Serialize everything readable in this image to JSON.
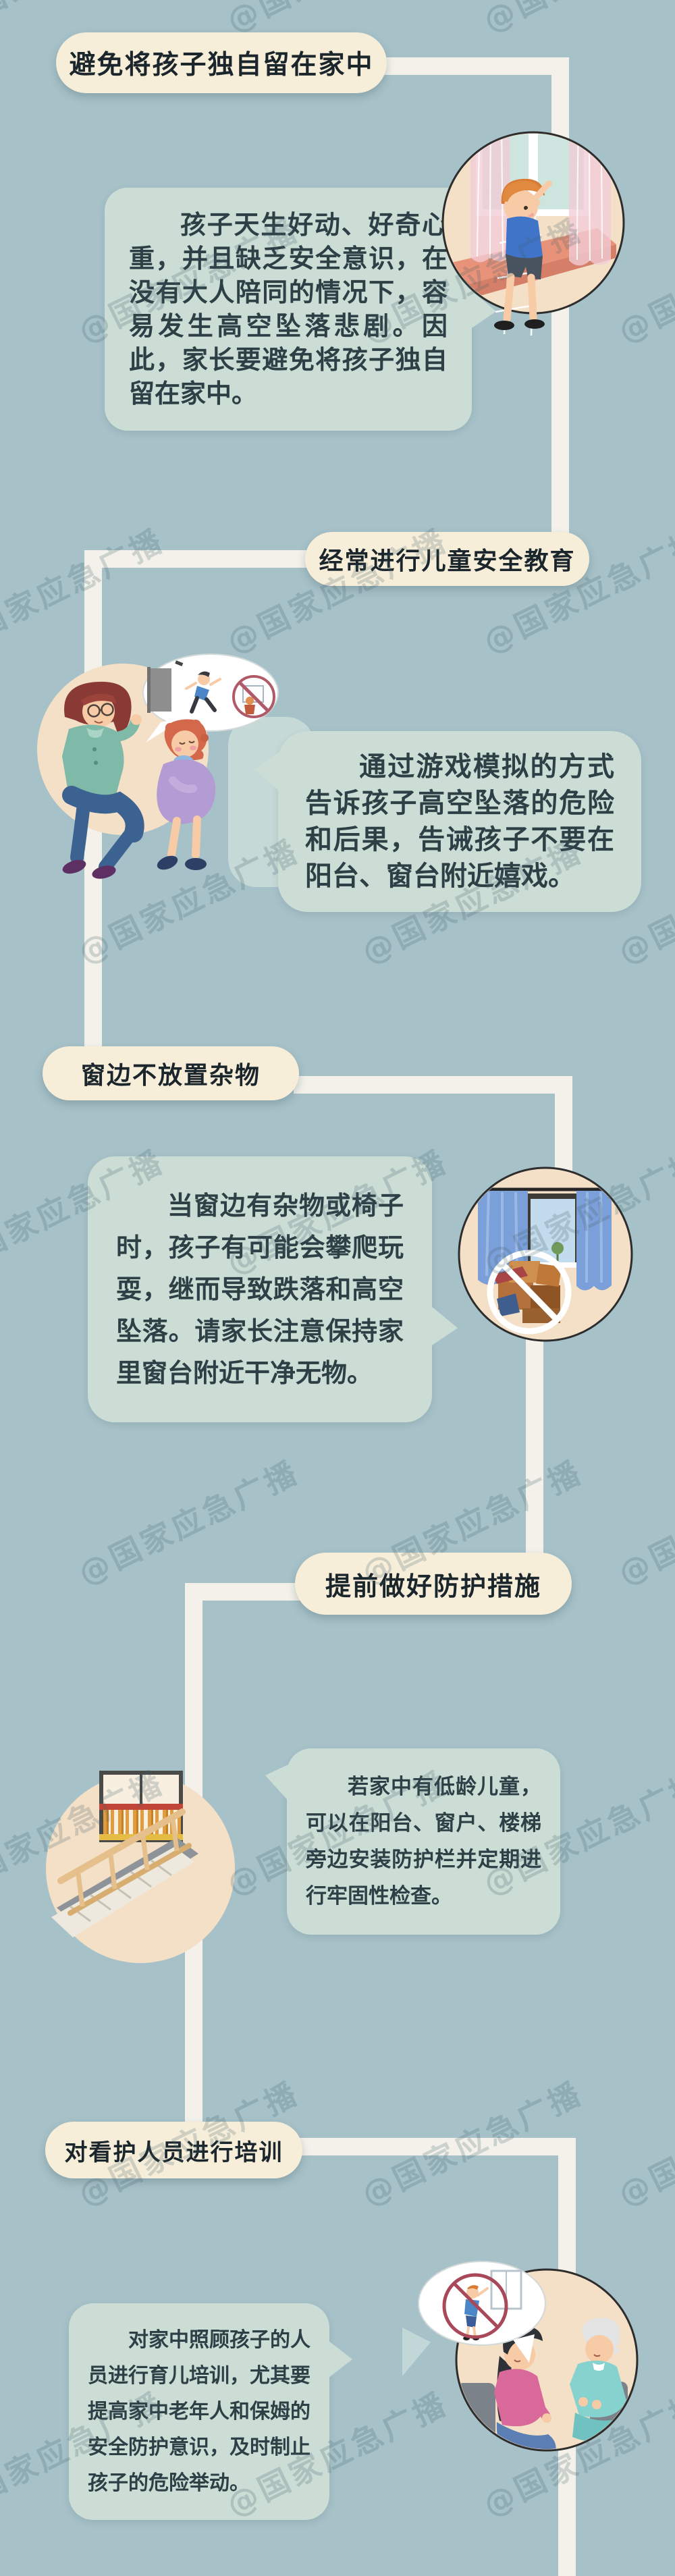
{
  "page": {
    "language": "zh-CN",
    "topic": "儿童高空坠落预防安全知识"
  },
  "watermark": {
    "text": "@国家应急广播"
  },
  "colors": {
    "background": "#a6c1c8",
    "title_pill": "#f7eeda",
    "speech_bubble": "#cbddd5",
    "illustration_circle": "#f4dfc7",
    "connector_line": "#f3f1ea",
    "title_text": "#1b262c",
    "body_text": "#2e4046",
    "watermark_text": "#3e5e6a"
  },
  "sections": [
    {
      "title": "避免将孩子独自留在家中",
      "body": "孩子天生好动、好奇心重，并且缺乏安全意识，在没有大人陪同的情况下，容易发生高空坠落悲剧。因此，家长要避免将孩子独自留在家中。",
      "illustration": "boy-climbing-at-window"
    },
    {
      "title": "经常进行儿童安全教育",
      "body": "通过游戏模拟的方式告诉孩子高空坠落的危险和后果，告诫孩子不要在阳台、窗台附近嬉戏。",
      "illustration": "adult-teaching-child-fall-danger"
    },
    {
      "title": "窗边不放置杂物",
      "body": "当窗边有杂物或椅子时，孩子有可能会攀爬玩耍，继而导致跌落和高空坠落。请家长注意保持家里窗台附近干净无物。",
      "illustration": "no-clutter-under-window"
    },
    {
      "title": "提前做好防护措施",
      "body": "若家中有低龄儿童，可以在阳台、窗户、楼梯旁边安装防护栏并定期进行牢固性检查。",
      "illustration": "guard-rail-on-balcony-and-stairs"
    },
    {
      "title": "对看护人员进行培训",
      "body": "对家中照顾孩子的人员进行育儿培训，尤其要提高家中老年人和保姆的安全防护意识，及时制止孩子的危险举动。",
      "illustration": "caregiver-training-talk"
    }
  ]
}
